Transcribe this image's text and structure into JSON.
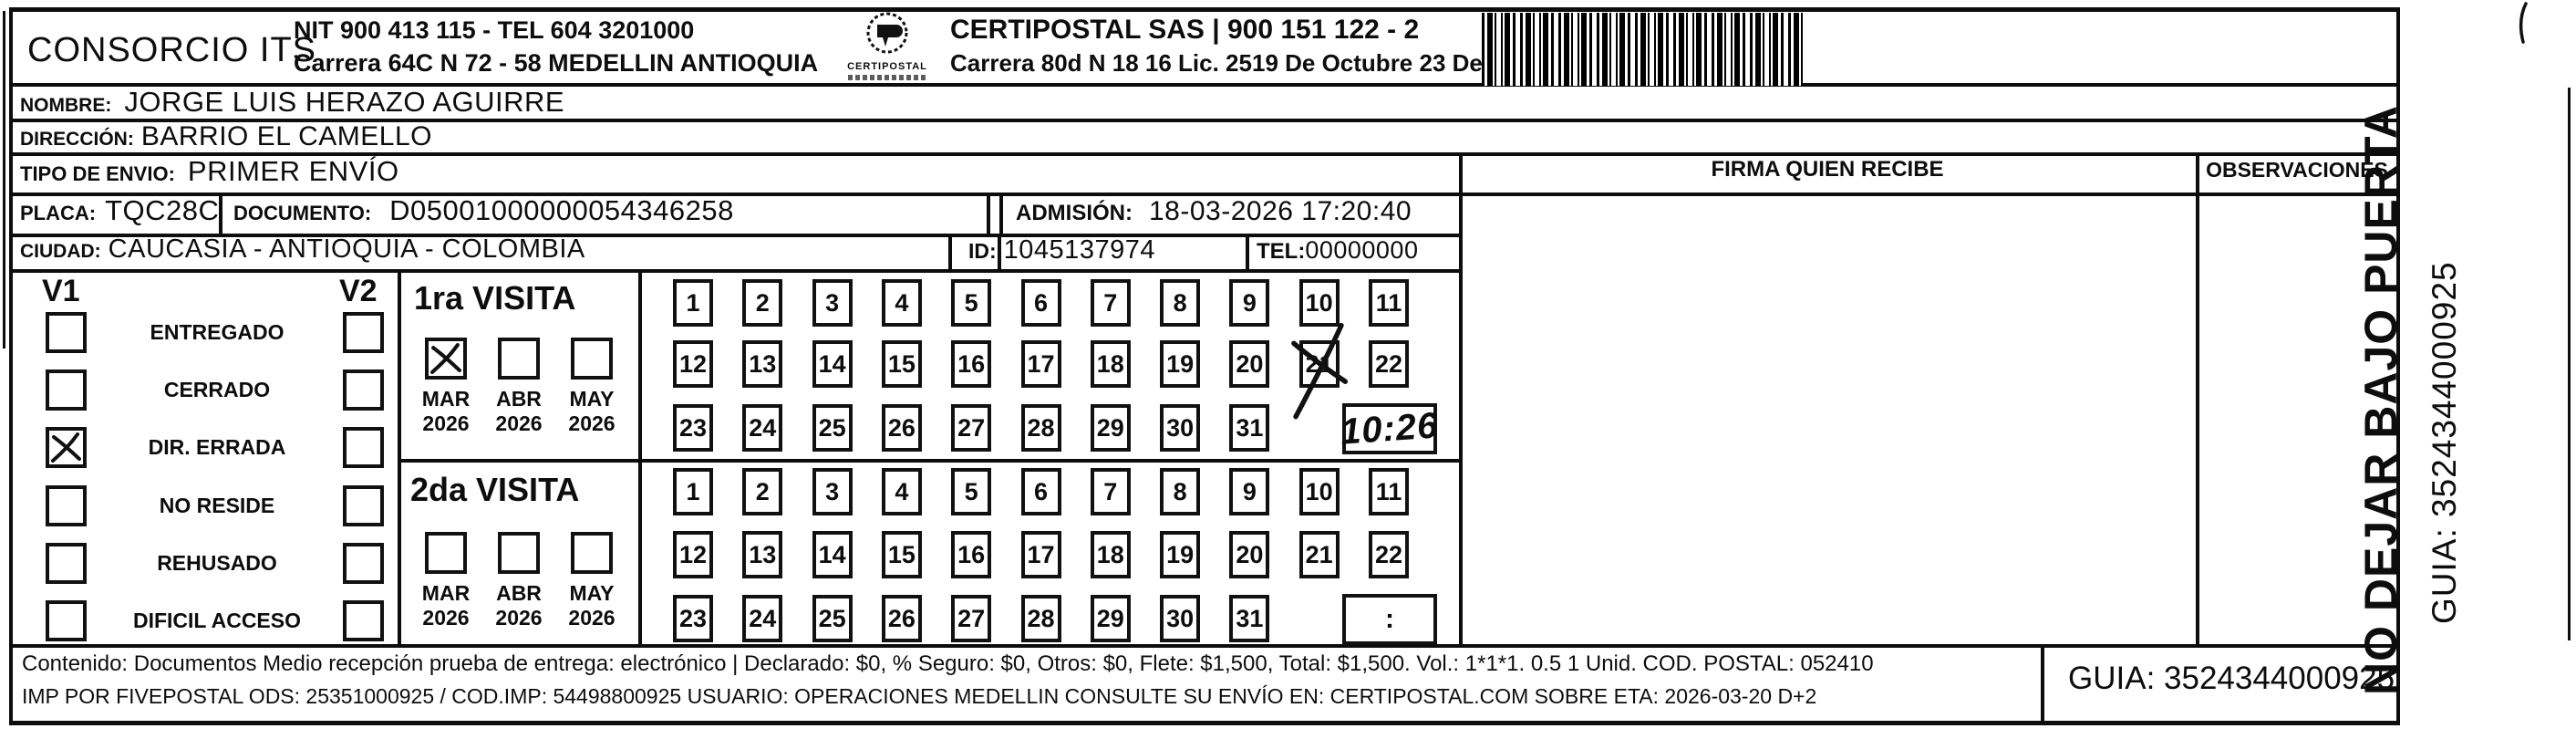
{
  "header": {
    "company": "CONSORCIO ITS",
    "nit_tel": "NIT 900 413 115 - TEL 604 3201000",
    "address": "Carrera 64C N 72 - 58 MEDELLIN ANTIOQUIA",
    "logo_name": "CERTIPOSTAL",
    "partner": "CERTIPOSTAL SAS | 900 151 122 - 2",
    "partner_address": "Carrera 80d N 18 16  Lic. 2519 De Octubre 23 De 2015"
  },
  "fields": {
    "nombre": {
      "label": "NOMBRE:",
      "value": "JORGE LUIS HERAZO AGUIRRE"
    },
    "direccion": {
      "label": "DIRECCIÓN:",
      "value": "BARRIO EL CAMELLO"
    },
    "tipo_envio": {
      "label": "TIPO DE ENVIO:",
      "value": "PRIMER ENVÍO"
    },
    "placa": {
      "label": "PLACA:",
      "value": "TQC28C"
    },
    "documento": {
      "label": "DOCUMENTO:",
      "value": "D05001000000054346258"
    },
    "admision": {
      "label": "ADMISIÓN:",
      "value": "18-03-2026 17:20:40"
    },
    "ciudad": {
      "label": "CIUDAD:",
      "value": "CAUCASIA - ANTIOQUIA - COLOMBIA"
    },
    "id": {
      "label": "ID:",
      "value": "1045137974"
    },
    "tel": {
      "label": "TEL:",
      "value": "00000000"
    }
  },
  "columns": {
    "firma": "FIRMA QUIEN RECIBE",
    "observaciones": "OBSERVACIONES"
  },
  "status_panel": {
    "col1": "V1",
    "col2": "V2",
    "items": [
      {
        "label": "ENTREGADO",
        "v1": false,
        "v2": false
      },
      {
        "label": "CERRADO",
        "v1": false,
        "v2": false
      },
      {
        "label": "DIR. ERRADA",
        "v1": true,
        "v2": false
      },
      {
        "label": "NO RESIDE",
        "v1": false,
        "v2": false
      },
      {
        "label": "REHUSADO",
        "v1": false,
        "v2": false
      },
      {
        "label": "DIFICIL ACCESO",
        "v1": false,
        "v2": false
      }
    ]
  },
  "visits": [
    {
      "title": "1ra VISITA",
      "months": [
        {
          "label": "MAR",
          "year": "2026",
          "checked": true
        },
        {
          "label": "ABR",
          "year": "2026",
          "checked": false
        },
        {
          "label": "MAY",
          "year": "2026",
          "checked": false
        }
      ],
      "marked_day": "21",
      "time": "10:26"
    },
    {
      "title": "2da VISITA",
      "months": [
        {
          "label": "MAR",
          "year": "2026",
          "checked": false
        },
        {
          "label": "ABR",
          "year": "2026",
          "checked": false
        },
        {
          "label": "MAY",
          "year": "2026",
          "checked": false
        }
      ],
      "marked_day": null,
      "time": ":"
    }
  ],
  "days": [
    "1",
    "2",
    "3",
    "4",
    "5",
    "6",
    "7",
    "8",
    "9",
    "10",
    "11",
    "12",
    "13",
    "14",
    "15",
    "16",
    "17",
    "18",
    "19",
    "20",
    "21",
    "22",
    "23",
    "24",
    "25",
    "26",
    "27",
    "28",
    "29",
    "30",
    "31"
  ],
  "side_note": {
    "line1": "NO DEJAR BAJO PUERTA",
    "line2": "GUIA: 3524344000925"
  },
  "footer": {
    "line1": "Contenido: Documentos Medio recepción prueba de entrega: electrónico | Declarado: $0, % Seguro: $0, Otros: $0, Flete: $1,500, Total: $1,500. Vol.: 1*1*1. 0.5  1 Unid. COD. POSTAL: 052410",
    "line2": "IMP POR FIVEPOSTAL ODS: 25351000925 / COD.IMP: 54498800925 USUARIO: OPERACIONES MEDELLIN CONSULTE SU ENVÍO EN: CERTIPOSTAL.COM SOBRE ETA: 2026-03-20 D+2",
    "guia": "GUIA: 3524344000925"
  }
}
